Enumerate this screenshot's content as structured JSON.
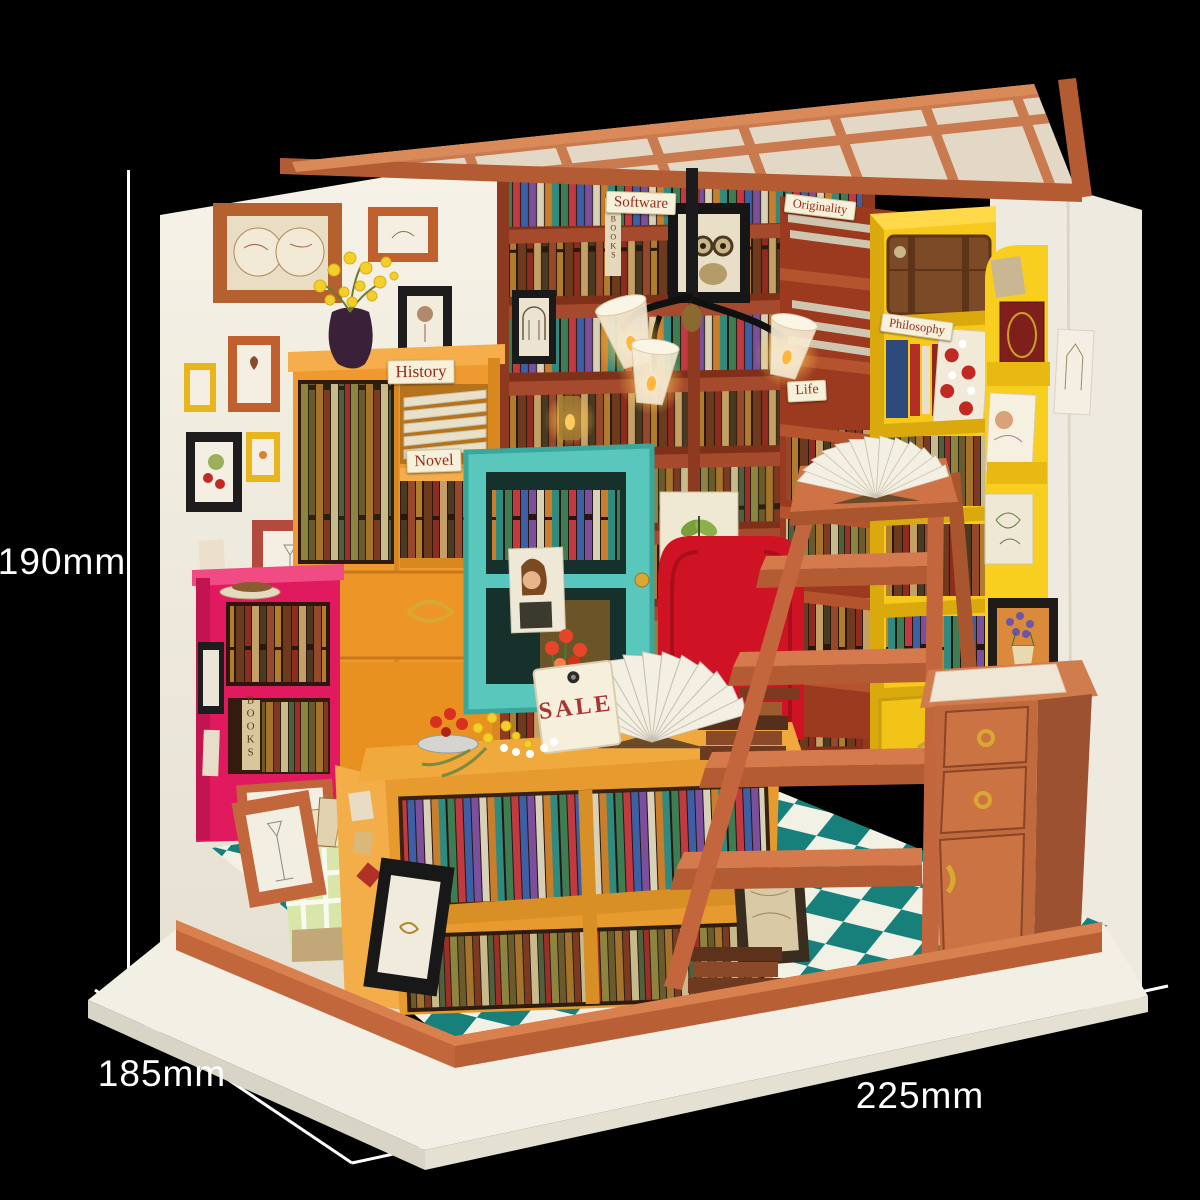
{
  "dimensions": {
    "height": "190mm",
    "depth": "185mm",
    "width": "225mm"
  },
  "signs": {
    "software": "Software",
    "originality": "Originality",
    "history": "History",
    "novel": "Novel",
    "philosophy": "Philosophy",
    "life": "Life",
    "sale": "SALE",
    "books_spine": "BOOKS"
  },
  "colors": {
    "background": "#000000",
    "dimension_text": "#ffffff",
    "wall_white": "#f2eee3",
    "roof_terracotta": "#c97a4e",
    "ladder_terracotta": "#c4663d",
    "base_platform": "#f2efe4",
    "base_rail": "#c2663c",
    "floor_teal": "#17807a",
    "floor_white": "#f2f1e6",
    "pink_shelf": "#e11a5f",
    "orange_cabinet": "#ef9a2e",
    "yellow_shelf": "#f6c91c",
    "teal_cabinet": "#5ac7bd",
    "red_armchair": "#d01324",
    "back_bookshelf": "#7e3018",
    "display_table": "#e79a2e",
    "sign_text": "#992a18"
  }
}
